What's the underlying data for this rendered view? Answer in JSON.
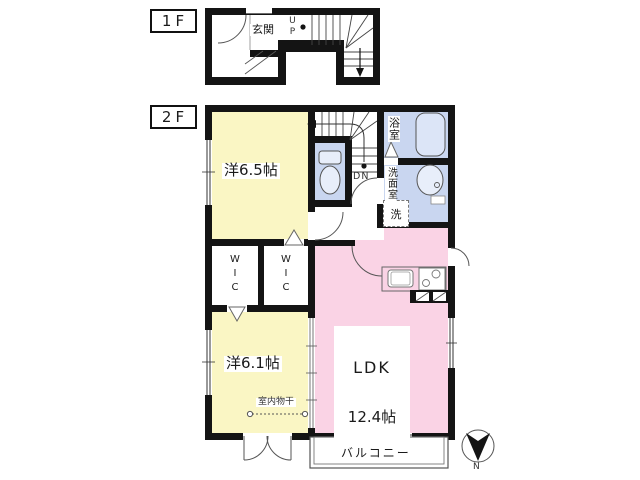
{
  "floor1": {
    "tag": "1F",
    "entrance": "玄関",
    "stairs_up": "UP"
  },
  "floor2": {
    "tag": "2F",
    "stairs_down": "DN",
    "bedroom1": "洋6.5帖",
    "bedroom2": "洋6.1帖",
    "ldk_name": "LDK",
    "ldk_size": "12.4帖",
    "bath": "浴室",
    "washroom": "洗面室",
    "laundry": "洗",
    "wic_left": "WIC",
    "wic_right": "WIC",
    "indoor_drying": "室内物干",
    "balcony": "バルコニー"
  },
  "compass": {
    "north": "N"
  },
  "colors": {
    "wall": "#141414",
    "bedroom": "#faf6c4",
    "ldk": "#fad3e5",
    "wet_area": "#c9d6f0"
  }
}
